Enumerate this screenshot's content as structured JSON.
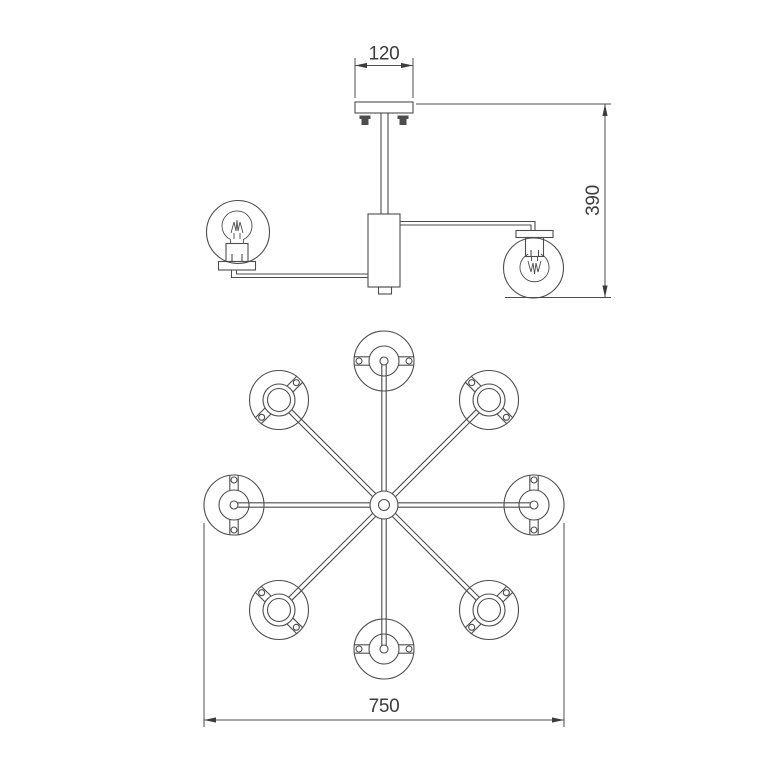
{
  "drawing": {
    "subject": "Ceiling chandelier technical drawing - 8 arms with globe shades",
    "side_view": {
      "bulbs_shown": 2
    },
    "plan_view": {
      "arms": 8,
      "shades": 8
    },
    "dimensions": {
      "canopy_width_mm": "120",
      "overall_height_mm": "390",
      "overall_diameter_mm": "750"
    },
    "colors": {
      "line": "#4d4d4d",
      "text": "#3c3c3c",
      "screw_fill": "#4d4d4d",
      "background": "#ffffff"
    }
  }
}
